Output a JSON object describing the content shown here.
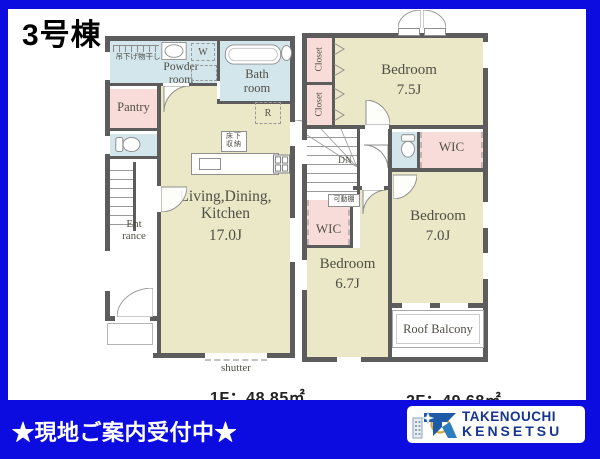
{
  "page": {
    "title": "3号棟"
  },
  "floor1": {
    "area_label": "1F：48.85㎡",
    "laundry_label": "吊下げ物干し",
    "powder_room": "Powder room",
    "washer": "W",
    "bath_room": "Bath room",
    "pantry": "Pantry",
    "fridge": "R",
    "floor_storage": "床下収納",
    "ldk_name": "Living,Dining, Kitchen",
    "ldk_size": "17.0J",
    "entrance": "Ent rance",
    "shutter": "shutter"
  },
  "floor2": {
    "area_label": "2F：49.68㎡",
    "closet_top": "Closet",
    "closet_bottom": "Closet",
    "bedroom_main": "Bedroom",
    "bedroom_main_size": "7.5J",
    "down_label": "DN",
    "wic_right": "WIC",
    "wic_left": "WIC",
    "movable_shelf": "可動棚",
    "bedroom_right": "Bedroom",
    "bedroom_right_size": "7.0J",
    "bedroom_left": "Bedroom",
    "bedroom_left_size": "6.7J",
    "roof_balcony": "Roof Balcony"
  },
  "banner": {
    "text": "★現地ご案内受付中★"
  },
  "logo": {
    "company_line1": "TAKENOUCHI",
    "company_line2": "KENSETSU"
  },
  "colors": {
    "frame_blue": "#0c0ce0",
    "wall_gray": "#5c5c5c",
    "room_yellow": "#eae8c6",
    "room_blue": "#d3e6ec",
    "room_pink": "#f8dcda",
    "logo_blue": "#14368f"
  }
}
